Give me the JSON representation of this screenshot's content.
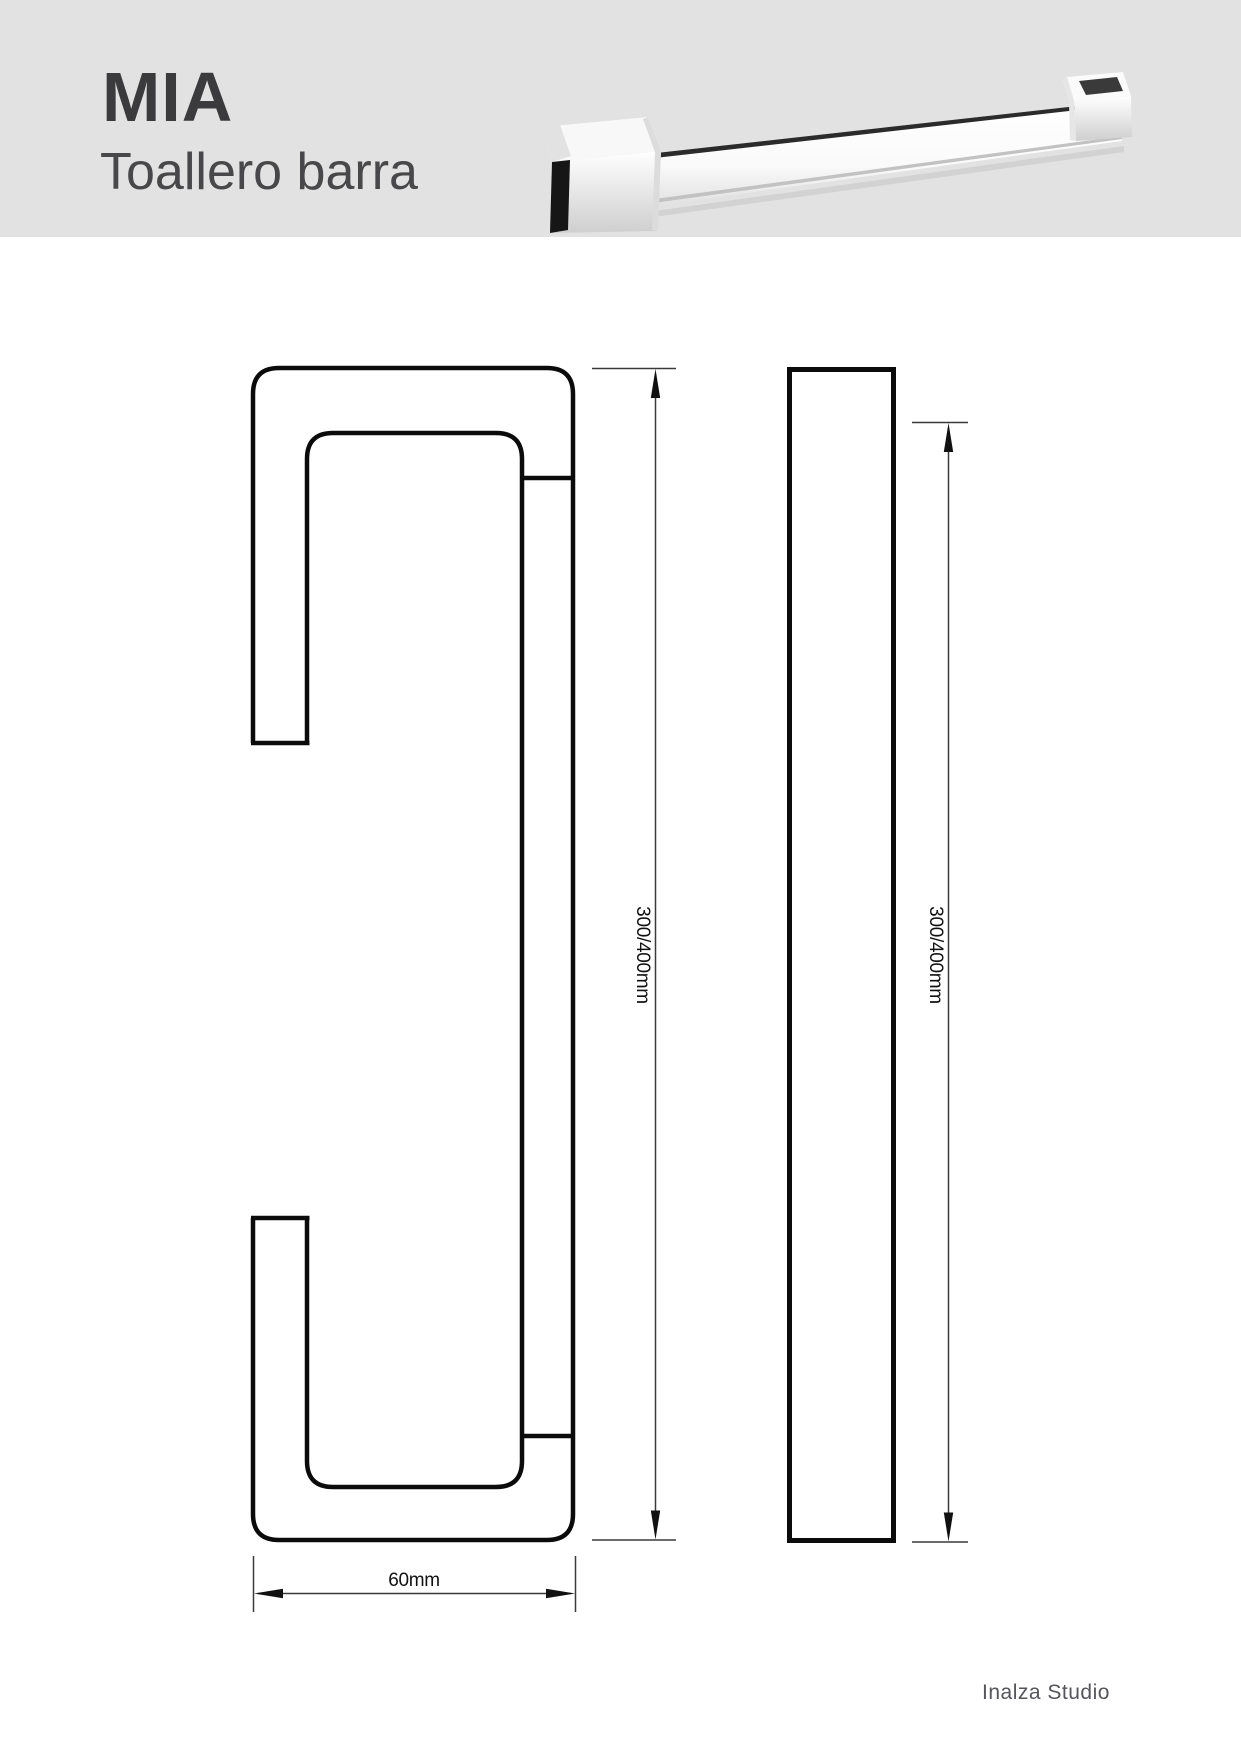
{
  "header": {
    "title": "MIA",
    "subtitle": "Toallero barra"
  },
  "dimensions": {
    "side_height_label": "300/400mm",
    "front_height_label": "300/400mm",
    "width_label": "60mm"
  },
  "footer": {
    "studio": "Inalza Studio"
  },
  "colors": {
    "header_bg": "#e2e2e2",
    "title_text": "#3b3b3d",
    "subtitle_text": "#48484a",
    "drawing_line": "#0b0b0b",
    "dimension_line": "#3a3a3a",
    "footer_text": "#55555a"
  }
}
